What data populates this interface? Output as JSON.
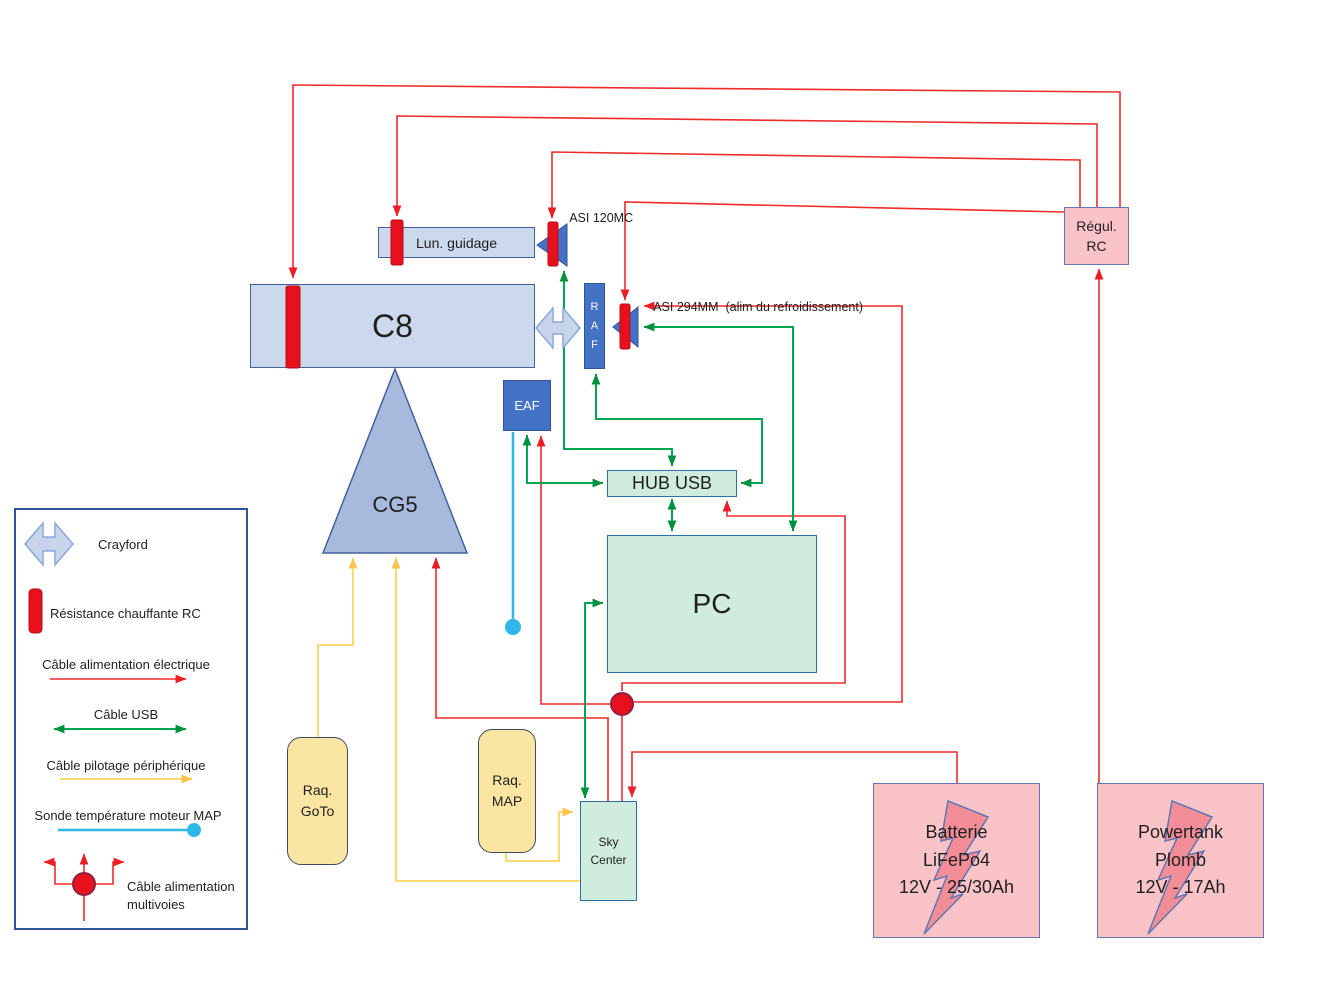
{
  "nodes": {
    "c8": {
      "label": "C8"
    },
    "lun_guidage": {
      "label": "Lun. guidage"
    },
    "raf": {
      "lines": [
        "R",
        "A",
        "F"
      ]
    },
    "eaf": {
      "label": "EAF"
    },
    "cg5": {
      "label": "CG5"
    },
    "hub_usb": {
      "label": "HUB USB"
    },
    "pc": {
      "label": "PC"
    },
    "sky_center": {
      "lines": [
        "Sky",
        "Center"
      ]
    },
    "raq_goto": {
      "lines": [
        "Raq.",
        "GoTo"
      ]
    },
    "raq_map": {
      "lines": [
        "Raq.",
        "MAP"
      ]
    },
    "batterie_lifepo4": {
      "lines": [
        "Batterie",
        "LiFePo4",
        "12V - 25/30Ah"
      ]
    },
    "powertank_plomb": {
      "lines": [
        "Powertank",
        "Plomb",
        "12V - 17Ah"
      ]
    },
    "regul_rc": {
      "lines": [
        "Régul.",
        "RC"
      ]
    }
  },
  "annotations": {
    "asi120": "ASI 120MC",
    "asi294": "ASI 294MM  (alim du refroidissement)"
  },
  "legend": {
    "crayford": "Crayford",
    "resistance_rc": "Résistance chauffante RC",
    "cable_alim": "Câble alimentation électrique",
    "cable_usb": "Câble USB",
    "cable_pilotage": "Câble pilotage périphérique",
    "sonde_map": "Sonde température moteur MAP",
    "cable_multivoies": [
      "Câble alimentation",
      "multivoies"
    ]
  },
  "colors": {
    "power_cable_red": "#ee2b2b",
    "usb_cable_green": "#00a651",
    "pilot_cable_yellow": "#ffd45e",
    "probe_cable_blue": "#31b6e7",
    "heater_red": "#e8101c",
    "node_light_blue": "#ccd8ec",
    "node_medium_blue": "#4472c4",
    "node_green": "#cfecdd",
    "node_yellow": "#fbe5a3",
    "node_pink": "#f9c3c8"
  }
}
